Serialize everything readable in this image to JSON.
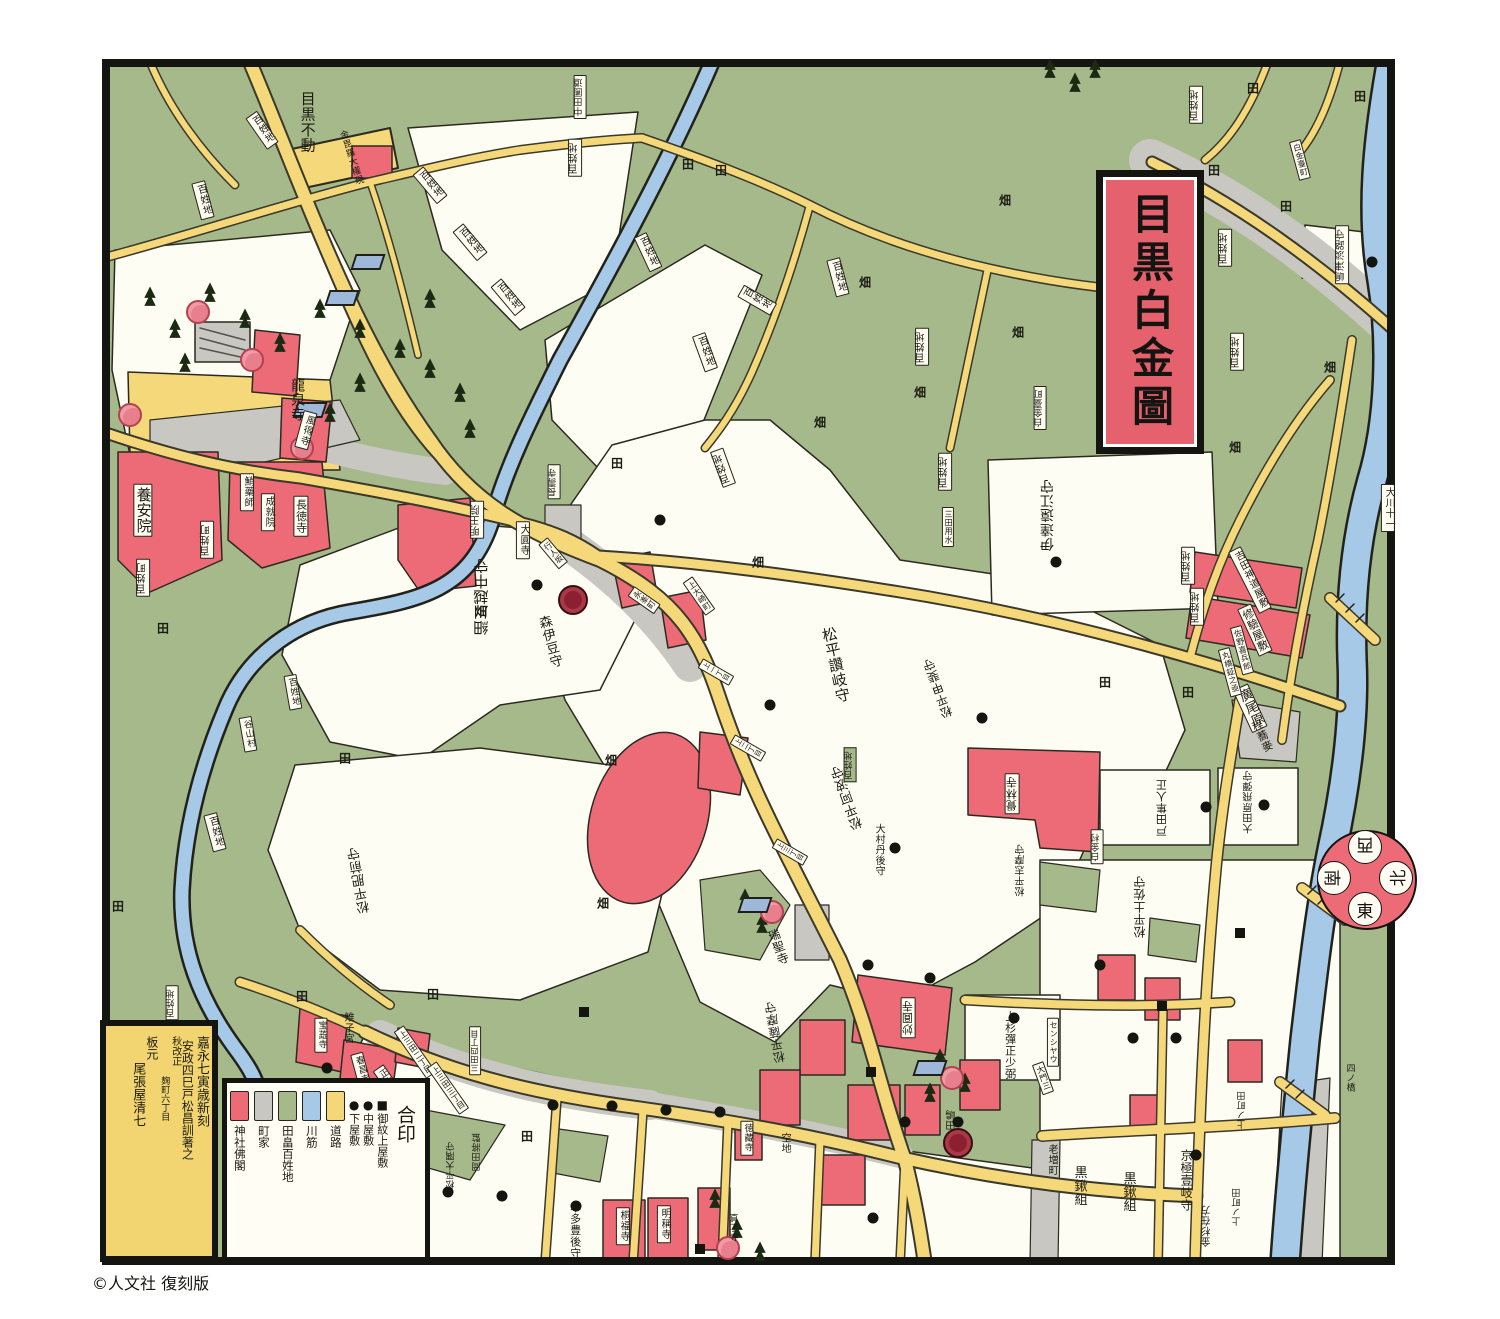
{
  "title": {
    "text": "目黒白金圖"
  },
  "copyright": "©人文社 復刻版",
  "colophon": {
    "columns": [
      "嘉永七寅歳新刻",
      "安政四巳戸松昌訓著之",
      "秋改正",
      "麹町六丁目",
      "板元",
      "尾張屋清七"
    ]
  },
  "legend": {
    "title": "合印",
    "symbols": [
      {
        "glyph": "■",
        "label": "御紋上屋敷"
      },
      {
        "glyph": "●",
        "label": "中屋敷"
      },
      {
        "glyph": "●",
        "label": "下屋敷"
      }
    ],
    "swatches": [
      {
        "color": "#f3d778",
        "label": "道路"
      },
      {
        "color": "#a6c9e8",
        "label": "川筋"
      },
      {
        "color": "#a5b98b",
        "label": "田畠百姓地"
      },
      {
        "color": "#c8c7c1",
        "label": "町家"
      },
      {
        "color": "#ec6b77",
        "label": "神社佛閣"
      }
    ]
  },
  "compass": {
    "dirs": [
      {
        "t": "西",
        "pos": "top",
        "rot": 180
      },
      {
        "t": "北",
        "pos": "right",
        "rot": -90
      },
      {
        "t": "東",
        "pos": "bottom",
        "rot": 0
      },
      {
        "t": "南",
        "pos": "left",
        "rot": 90
      }
    ]
  },
  "colors": {
    "field_green": "#a5b98b",
    "road_yellow": "#f5d87a",
    "river_blue": "#a6c9e8",
    "plot_white": "#fdfdf4",
    "temple_red": "#ec6b77",
    "townhouse_gray": "#c8c7c1",
    "frame_black": "#141410",
    "title_red": "#e5616e"
  },
  "labels": [
    {
      "t": "目黒不動",
      "x": 307,
      "y": 122,
      "s": 15,
      "r": 0,
      "b": 0
    },
    {
      "t": "龍泉寺",
      "x": 297,
      "y": 400,
      "s": 14,
      "r": 0,
      "b": 0
    },
    {
      "t": "金毘羅大權現",
      "x": 350,
      "y": 158,
      "s": 9,
      "r": -18,
      "b": 0
    },
    {
      "t": "養安院",
      "x": 143,
      "y": 510,
      "s": 15,
      "r": 0,
      "b": 1
    },
    {
      "t": "鮹藥師",
      "x": 247,
      "y": 492,
      "s": 10,
      "r": 0,
      "b": 1
    },
    {
      "t": "成就院",
      "x": 268,
      "y": 512,
      "s": 10,
      "r": 0,
      "b": 1
    },
    {
      "t": "長徳寺",
      "x": 301,
      "y": 516,
      "s": 11,
      "r": 0,
      "b": 1
    },
    {
      "t": "風得寺",
      "x": 306,
      "y": 430,
      "s": 10,
      "r": 15,
      "b": 1
    },
    {
      "t": "百姓町",
      "x": 143,
      "y": 578,
      "s": 10,
      "r": 180,
      "b": 1
    },
    {
      "t": "百姓町",
      "x": 207,
      "y": 540,
      "s": 10,
      "r": 180,
      "b": 1
    },
    {
      "t": "百姓地",
      "x": 203,
      "y": 200,
      "s": 10,
      "r": -15,
      "b": 1
    },
    {
      "t": "百姓地",
      "x": 262,
      "y": 130,
      "s": 10,
      "r": -35,
      "b": 1
    },
    {
      "t": "百姓地",
      "x": 430,
      "y": 185,
      "s": 10,
      "r": -40,
      "b": 1
    },
    {
      "t": "百姓地",
      "x": 470,
      "y": 242,
      "s": 10,
      "r": -40,
      "b": 1
    },
    {
      "t": "百姓地",
      "x": 508,
      "y": 297,
      "s": 10,
      "r": -40,
      "b": 1
    },
    {
      "t": "百姓地",
      "x": 575,
      "y": 158,
      "s": 10,
      "r": 180,
      "b": 1
    },
    {
      "t": "中田圃道",
      "x": 580,
      "y": 97,
      "s": 9,
      "r": 180,
      "b": 1
    },
    {
      "t": "百姓地",
      "x": 648,
      "y": 252,
      "s": 10,
      "r": -25,
      "b": 1
    },
    {
      "t": "百姓地",
      "x": 705,
      "y": 352,
      "s": 10,
      "r": -20,
      "b": 1
    },
    {
      "t": "百姓地",
      "x": 757,
      "y": 300,
      "s": 10,
      "r": -60,
      "b": 1
    },
    {
      "t": "百姓地",
      "x": 838,
      "y": 277,
      "s": 10,
      "r": -15,
      "b": 1
    },
    {
      "t": "百姓地",
      "x": 922,
      "y": 347,
      "s": 10,
      "r": 180,
      "b": 1
    },
    {
      "t": "百姓地",
      "x": 945,
      "y": 472,
      "s": 10,
      "r": 180,
      "b": 1
    },
    {
      "t": "白金臺町",
      "x": 1040,
      "y": 408,
      "s": 9,
      "r": 180,
      "b": 1
    },
    {
      "t": "伊達遠江守",
      "x": 1048,
      "y": 515,
      "s": 14,
      "r": 180,
      "b": 0
    },
    {
      "t": "百姓地",
      "x": 1196,
      "y": 105,
      "s": 10,
      "r": 180,
      "b": 1
    },
    {
      "t": "百姓地",
      "x": 1225,
      "y": 248,
      "s": 10,
      "r": 180,
      "b": 1
    },
    {
      "t": "嶋津淡路守",
      "x": 1342,
      "y": 255,
      "s": 10,
      "r": 180,
      "b": 1
    },
    {
      "t": "百姓地",
      "x": 1237,
      "y": 352,
      "s": 10,
      "r": 180,
      "b": 1
    },
    {
      "t": "百姓地",
      "x": 1188,
      "y": 566,
      "s": 10,
      "r": 180,
      "b": 1
    },
    {
      "t": "百姓地",
      "x": 1197,
      "y": 607,
      "s": 10,
      "r": 180,
      "b": 1
    },
    {
      "t": "吉田神道屋敷",
      "x": 1250,
      "y": 580,
      "s": 10,
      "r": -27,
      "b": 1
    },
    {
      "t": "修驗屋敷",
      "x": 1255,
      "y": 630,
      "s": 11,
      "r": -25,
      "b": 1
    },
    {
      "t": "廣尾原",
      "x": 1250,
      "y": 708,
      "s": 13,
      "r": -25,
      "b": 1
    },
    {
      "t": "佐野喜兵郎",
      "x": 1242,
      "y": 650,
      "s": 8,
      "r": -15,
      "b": 1
    },
    {
      "t": "丸橋鉦之亟",
      "x": 1230,
      "y": 672,
      "s": 8,
      "r": -15,
      "b": 1
    },
    {
      "t": "程蕎麥",
      "x": 1262,
      "y": 736,
      "s": 11,
      "r": -25,
      "b": 0
    },
    {
      "t": "大川十一",
      "x": 1388,
      "y": 508,
      "s": 10,
      "r": 0,
      "b": 1
    },
    {
      "t": "大田原飛彈守",
      "x": 1250,
      "y": 802,
      "s": 10,
      "r": 180,
      "b": 0
    },
    {
      "t": "戸田隼人正",
      "x": 1162,
      "y": 808,
      "s": 11,
      "r": 180,
      "b": 0
    },
    {
      "t": "白金村",
      "x": 1097,
      "y": 847,
      "s": 9,
      "r": 180,
      "b": 1
    },
    {
      "t": "松平志摩守",
      "x": 1022,
      "y": 870,
      "s": 10,
      "r": 180,
      "b": 0
    },
    {
      "t": "覺林寺",
      "x": 1012,
      "y": 794,
      "s": 11,
      "r": 180,
      "b": 1
    },
    {
      "t": "松平土佐守",
      "x": 1140,
      "y": 907,
      "s": 12,
      "r": 180,
      "b": 0
    },
    {
      "t": "妙圓寺",
      "x": 908,
      "y": 1018,
      "s": 11,
      "r": 180,
      "b": 1
    },
    {
      "t": "瑞聖寺",
      "x": 778,
      "y": 947,
      "s": 12,
      "r": -20,
      "b": 0
    },
    {
      "t": "松平薩摩守",
      "x": 775,
      "y": 1032,
      "s": 12,
      "r": 170,
      "b": 0
    },
    {
      "t": "上杉彈正少弼",
      "x": 1010,
      "y": 1045,
      "s": 11,
      "r": 0,
      "b": 0
    },
    {
      "t": "センシヤウ",
      "x": 1053,
      "y": 1042,
      "s": 8,
      "r": 0,
      "b": 1
    },
    {
      "t": "大門三",
      "x": 1043,
      "y": 1078,
      "s": 8,
      "r": -20,
      "b": 1
    },
    {
      "t": "田嶋",
      "x": 953,
      "y": 1120,
      "s": 10,
      "r": 180,
      "b": 0
    },
    {
      "t": "空地",
      "x": 784,
      "y": 1143,
      "s": 10,
      "r": 0,
      "b": 0
    },
    {
      "t": "徳藏寺",
      "x": 747,
      "y": 1138,
      "s": 9,
      "r": 0,
      "b": 1
    },
    {
      "t": "三田用水",
      "x": 948,
      "y": 527,
      "s": 8,
      "r": 0,
      "b": 1
    },
    {
      "t": "細川越中守",
      "x": 482,
      "y": 597,
      "s": 15,
      "r": 180,
      "b": 0
    },
    {
      "t": "森伊豆守",
      "x": 549,
      "y": 642,
      "s": 13,
      "r": -15,
      "b": 0
    },
    {
      "t": "大圓寺",
      "x": 523,
      "y": 540,
      "s": 10,
      "r": 0,
      "b": 1
    },
    {
      "t": "明王院",
      "x": 477,
      "y": 520,
      "s": 10,
      "r": 180,
      "b": 1
    },
    {
      "t": "長壽寺",
      "x": 554,
      "y": 482,
      "s": 9,
      "r": 180,
      "b": 1
    },
    {
      "t": "行人坂",
      "x": 553,
      "y": 553,
      "s": 8,
      "r": -40,
      "b": 1
    },
    {
      "t": "永峯町",
      "x": 644,
      "y": 600,
      "s": 8,
      "r": -55,
      "b": 1
    },
    {
      "t": "上大崎町",
      "x": 699,
      "y": 596,
      "s": 8,
      "r": -35,
      "b": 1
    },
    {
      "t": "松平讚岐守",
      "x": 835,
      "y": 665,
      "s": 15,
      "r": -12,
      "b": 0
    },
    {
      "t": "松平甲斐守",
      "x": 938,
      "y": 688,
      "s": 12,
      "r": 160,
      "b": 0
    },
    {
      "t": "松平阿波守",
      "x": 848,
      "y": 797,
      "s": 13,
      "r": 160,
      "b": 0
    },
    {
      "t": "百姓地",
      "x": 850,
      "y": 765,
      "s": 9,
      "r": 180,
      "b": 2
    },
    {
      "t": "大村丹後守",
      "x": 878,
      "y": 850,
      "s": 10,
      "r": 0,
      "b": 0
    },
    {
      "t": "上一丁目",
      "x": 716,
      "y": 672,
      "s": 7,
      "r": -60,
      "b": 1
    },
    {
      "t": "上二丁目",
      "x": 748,
      "y": 748,
      "s": 7,
      "r": -60,
      "b": 1
    },
    {
      "t": "上三丁目",
      "x": 790,
      "y": 852,
      "s": 7,
      "r": -60,
      "b": 1
    },
    {
      "t": "上三田二丁目",
      "x": 415,
      "y": 1052,
      "s": 8,
      "r": -35,
      "b": 1
    },
    {
      "t": "上三田三丁目",
      "x": 448,
      "y": 1088,
      "s": 8,
      "r": -35,
      "b": 1
    },
    {
      "t": "三田四丁目",
      "x": 475,
      "y": 1051,
      "s": 8,
      "r": 180,
      "b": 1
    },
    {
      "t": "雉子宮",
      "x": 347,
      "y": 1028,
      "s": 10,
      "r": 0,
      "b": 0
    },
    {
      "t": "宝蕋寺",
      "x": 321,
      "y": 1035,
      "s": 9,
      "r": 0,
      "b": 1
    },
    {
      "t": "春昌寺",
      "x": 361,
      "y": 1070,
      "s": 9,
      "r": -15,
      "b": 1
    },
    {
      "t": "正立寺",
      "x": 388,
      "y": 1082,
      "s": 9,
      "r": -35,
      "b": 1
    },
    {
      "t": "松平大隅守",
      "x": 452,
      "y": 1165,
      "s": 9,
      "r": 180,
      "b": 0
    },
    {
      "t": "岡田將監",
      "x": 478,
      "y": 1152,
      "s": 9,
      "r": 180,
      "b": 0
    },
    {
      "t": "本多豊後守",
      "x": 575,
      "y": 1230,
      "s": 11,
      "r": 0,
      "b": 0
    },
    {
      "t": "桐福寺",
      "x": 623,
      "y": 1226,
      "s": 10,
      "r": 0,
      "b": 1
    },
    {
      "t": "明稱寺",
      "x": 664,
      "y": 1224,
      "s": 10,
      "r": 0,
      "b": 1
    },
    {
      "t": "真了寺",
      "x": 732,
      "y": 1228,
      "s": 9,
      "r": 0,
      "b": 0
    },
    {
      "t": "黒鍬組",
      "x": 1079,
      "y": 1186,
      "s": 13,
      "r": 0,
      "b": 0
    },
    {
      "t": "黒鍬組",
      "x": 1128,
      "y": 1192,
      "s": 13,
      "r": 0,
      "b": 0
    },
    {
      "t": "京極壹岐守",
      "x": 1186,
      "y": 1180,
      "s": 12,
      "r": 0,
      "b": 0
    },
    {
      "t": "金杉在方",
      "x": 1208,
      "y": 1226,
      "s": 10,
      "r": 180,
      "b": 0
    },
    {
      "t": "上ノ町田",
      "x": 1243,
      "y": 1110,
      "s": 9,
      "r": 180,
      "b": 0
    },
    {
      "t": "上ノ町田",
      "x": 1238,
      "y": 1207,
      "s": 9,
      "r": 180,
      "b": 0
    },
    {
      "t": "老増町",
      "x": 1051,
      "y": 1160,
      "s": 10,
      "r": 0,
      "b": 0
    },
    {
      "t": "四ノ橋",
      "x": 1349,
      "y": 1078,
      "s": 9,
      "r": 0,
      "b": 0
    },
    {
      "t": "白金臺町",
      "x": 1300,
      "y": 160,
      "s": 8,
      "r": -15,
      "b": 1
    },
    {
      "t": "谷山村",
      "x": 248,
      "y": 734,
      "s": 9,
      "r": -10,
      "b": 1
    },
    {
      "t": "百姓地",
      "x": 293,
      "y": 692,
      "s": 9,
      "r": -10,
      "b": 1
    },
    {
      "t": "百姓地",
      "x": 215,
      "y": 832,
      "s": 10,
      "r": -15,
      "b": 1
    },
    {
      "t": "百姓地",
      "x": 172,
      "y": 1003,
      "s": 9,
      "r": 180,
      "b": 1
    },
    {
      "t": "松平肥前守",
      "x": 360,
      "y": 880,
      "s": 13,
      "r": 170,
      "b": 0
    },
    {
      "t": "百姓地",
      "x": 723,
      "y": 468,
      "s": 10,
      "r": 160,
      "b": 1
    }
  ],
  "field_marks": [
    {
      "t": "田",
      "x": 688,
      "y": 164
    },
    {
      "t": "田",
      "x": 721,
      "y": 170
    },
    {
      "t": "田",
      "x": 1253,
      "y": 88
    },
    {
      "t": "田",
      "x": 1360,
      "y": 96
    },
    {
      "t": "田",
      "x": 1214,
      "y": 170
    },
    {
      "t": "田",
      "x": 1286,
      "y": 206
    },
    {
      "t": "田",
      "x": 163,
      "y": 628
    },
    {
      "t": "田",
      "x": 302,
      "y": 996
    },
    {
      "t": "田",
      "x": 345,
      "y": 758
    },
    {
      "t": "田",
      "x": 433,
      "y": 994
    },
    {
      "t": "田",
      "x": 1105,
      "y": 682
    },
    {
      "t": "田",
      "x": 1188,
      "y": 692
    },
    {
      "t": "田",
      "x": 527,
      "y": 1136
    },
    {
      "t": "田",
      "x": 617,
      "y": 463
    },
    {
      "t": "田",
      "x": 118,
      "y": 906
    },
    {
      "t": "畑",
      "x": 611,
      "y": 760
    },
    {
      "t": "畑",
      "x": 603,
      "y": 903
    },
    {
      "t": "畑",
      "x": 920,
      "y": 392
    },
    {
      "t": "畑",
      "x": 865,
      "y": 282
    },
    {
      "t": "畑",
      "x": 820,
      "y": 422
    },
    {
      "t": "畑",
      "x": 1018,
      "y": 332
    },
    {
      "t": "畑",
      "x": 1235,
      "y": 447
    },
    {
      "t": "畑",
      "x": 1330,
      "y": 367
    },
    {
      "t": "畑",
      "x": 481,
      "y": 611
    },
    {
      "t": "畑",
      "x": 758,
      "y": 562
    },
    {
      "t": "畑",
      "x": 1005,
      "y": 200
    }
  ],
  "dots": [
    [
      770,
      705
    ],
    [
      982,
      718
    ],
    [
      895,
      848
    ],
    [
      537,
      585
    ],
    [
      1056,
      562
    ],
    [
      1206,
      807
    ],
    [
      1264,
      805
    ],
    [
      1014,
      1018
    ],
    [
      576,
      1206
    ],
    [
      1196,
      1155
    ],
    [
      327,
      1068
    ],
    [
      1372,
      262
    ],
    [
      448,
      1192
    ],
    [
      502,
      1196
    ],
    [
      553,
      1105
    ],
    [
      612,
      1106
    ],
    [
      666,
      1110
    ],
    [
      720,
      1112
    ],
    [
      868,
      965
    ],
    [
      930,
      978
    ],
    [
      1100,
      965
    ],
    [
      1133,
      1038
    ],
    [
      1176,
      1038
    ],
    [
      873,
      1218
    ],
    [
      905,
      1122
    ],
    [
      958,
      1122
    ],
    [
      660,
      520
    ]
  ],
  "squares": [
    [
      584,
      1012
    ],
    [
      871,
      1072
    ],
    [
      1162,
      1006
    ],
    [
      700,
      1249
    ],
    [
      1240,
      933
    ]
  ],
  "mons": [
    [
      573,
      600
    ],
    [
      958,
      1143
    ]
  ],
  "groves": [
    {
      "x": 150,
      "y": 300,
      "k": "pine"
    },
    {
      "x": 175,
      "y": 332,
      "k": "pine"
    },
    {
      "x": 210,
      "y": 296,
      "k": "pine"
    },
    {
      "x": 245,
      "y": 322,
      "k": "pine"
    },
    {
      "x": 280,
      "y": 346,
      "k": "pine"
    },
    {
      "x": 320,
      "y": 312,
      "k": "pine"
    },
    {
      "x": 360,
      "y": 332,
      "k": "pine"
    },
    {
      "x": 400,
      "y": 352,
      "k": "pine"
    },
    {
      "x": 430,
      "y": 372,
      "k": "pine"
    },
    {
      "x": 460,
      "y": 396,
      "k": "pine"
    },
    {
      "x": 185,
      "y": 366,
      "k": "pine"
    },
    {
      "x": 330,
      "y": 416,
      "k": "pine"
    },
    {
      "x": 430,
      "y": 302,
      "k": "pine"
    },
    {
      "x": 470,
      "y": 432,
      "k": "pine"
    },
    {
      "x": 360,
      "y": 386,
      "k": "pine"
    },
    {
      "x": 745,
      "y": 902,
      "k": "pine"
    },
    {
      "x": 762,
      "y": 927,
      "k": "pine"
    },
    {
      "x": 940,
      "y": 1062,
      "k": "pine"
    },
    {
      "x": 965,
      "y": 1086,
      "k": "pine"
    },
    {
      "x": 715,
      "y": 1202,
      "k": "pine"
    },
    {
      "x": 737,
      "y": 1232,
      "k": "pine"
    },
    {
      "x": 760,
      "y": 1255,
      "k": "pine"
    },
    {
      "x": 1050,
      "y": 72,
      "k": "pine"
    },
    {
      "x": 1075,
      "y": 86,
      "k": "pine"
    },
    {
      "x": 1095,
      "y": 72,
      "k": "pine"
    },
    {
      "x": 930,
      "y": 1096,
      "k": "pine"
    },
    {
      "x": 130,
      "y": 415,
      "k": "sakura"
    },
    {
      "x": 198,
      "y": 312,
      "k": "sakura"
    },
    {
      "x": 252,
      "y": 360,
      "k": "sakura"
    },
    {
      "x": 302,
      "y": 448,
      "k": "sakura"
    },
    {
      "x": 772,
      "y": 912,
      "k": "sakura"
    },
    {
      "x": 952,
      "y": 1078,
      "k": "sakura"
    },
    {
      "x": 728,
      "y": 1248,
      "k": "sakura"
    },
    {
      "x": 342,
      "y": 298,
      "k": "roof"
    },
    {
      "x": 368,
      "y": 262,
      "k": "roof"
    },
    {
      "x": 310,
      "y": 410,
      "k": "roof"
    },
    {
      "x": 755,
      "y": 905,
      "k": "roof"
    },
    {
      "x": 930,
      "y": 1068,
      "k": "roof"
    }
  ]
}
